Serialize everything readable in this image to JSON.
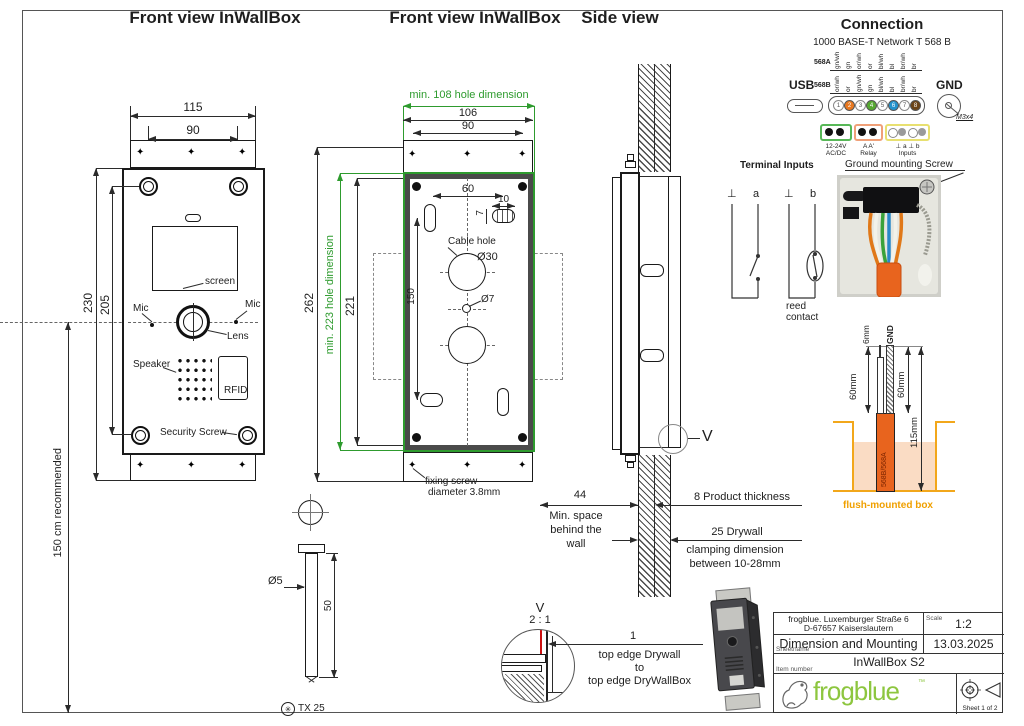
{
  "titles": {
    "view1": "Front view InWallBox",
    "view2": "Front view InWallBox",
    "side": "Side view",
    "connection": "Connection",
    "network": "1000 BASE-T Network T 568 B"
  },
  "icons": {
    "diamond": "✦",
    "torx": "✳"
  },
  "view1": {
    "d115": "115",
    "d90": "90",
    "d230": "230",
    "d205": "205",
    "height": "150 cm recommended",
    "screen": "screen",
    "mic_l": "Mic",
    "mic_r": "Mic",
    "lens": "Lens",
    "speaker": "Speaker",
    "rfid": "RFID",
    "security": "Security Screw"
  },
  "view2": {
    "min_w": "min. 108 hole dimension",
    "d106": "106",
    "d90": "90",
    "min_h": "min. 223 hole dimension",
    "d262": "262",
    "d221": "221",
    "d150": "150",
    "d60": "60",
    "d10": "10",
    "d7": "7",
    "cable_hole": "Cable hole",
    "d30": "Ø30",
    "d7h": "Ø7",
    "fix1": "fixing screw",
    "fix2": "diameter 3.8mm"
  },
  "side": {
    "v": "V",
    "d44": "44",
    "sp1": "Min. space",
    "sp2": "behind the",
    "sp3": "wall",
    "thick": "8 Product thickness",
    "dw1": "25 Drywall",
    "dw2": "clamping dimension",
    "dw3": "between 10-28mm"
  },
  "screw": {
    "d5": "Ø5",
    "d50": "50",
    "tx": "TX 25"
  },
  "detail": {
    "v": "V",
    "scale": "2 : 1",
    "d1": "1",
    "l1": "top edge Drywall",
    "l2": "to",
    "l3": "top edge DryWallBox"
  },
  "conn": {
    "a": "568A",
    "b": "568B",
    "wa": [
      "gn/wh",
      "gn",
      "or/wh",
      "or",
      "bl/wh",
      "bl",
      "br/wh",
      "br"
    ],
    "wb": [
      "or/wh",
      "or",
      "gn/wh",
      "gn",
      "bl/wh",
      "bl",
      "br/wh",
      "br"
    ],
    "pins": [
      "1",
      "2",
      "3",
      "4",
      "5",
      "6",
      "7",
      "8"
    ],
    "usb": "USB",
    "gnd": "GND",
    "m3": "M3x4",
    "pw1": "12-24V",
    "pw2": "AC/DC",
    "rt": "A  A'",
    "relay": "Relay",
    "it": "⊥  a  ⊥  b",
    "inputs": "Inputs",
    "ti": "Terminal Inputs",
    "gms": "Ground mounting Screw",
    "s1": "⊥",
    "s2": "a",
    "s3": "⊥",
    "s4": "b",
    "reed1": "reed",
    "reed2": "contact"
  },
  "cable": {
    "tip": "6mm",
    "gnd": "GND",
    "l60": "60mm",
    "r60": "60mm",
    "total": "115mm",
    "label": "568B/568A",
    "box": "flush-mounted box"
  },
  "tb": {
    "addr1": "frogblue. Luxemburger Straße 6",
    "addr2": "D-67657 Kaiserslautern",
    "scale_l": "Scale",
    "scale": "1:2",
    "sheet_l": "Sheetname",
    "name": "Dimension and Mounting",
    "date": "13.03.2025",
    "item_l": "Item number",
    "item": "InWallBox S2",
    "brand": "frogblue",
    "tm": "™",
    "sheet": "Sheet 1 of 2"
  },
  "colors": {
    "dim_green": "#2e9b2e",
    "brand_green": "#8dc63f",
    "cable_orange": "#e8641e",
    "box_yellow": "#f2a71b",
    "wall_peach": "#fadcc4",
    "pin_orange": "#e87820",
    "pin_green": "#56a832",
    "pin_blue": "#2492cc",
    "pin_brown": "#6b4418",
    "detail_red": "#cc1111"
  }
}
